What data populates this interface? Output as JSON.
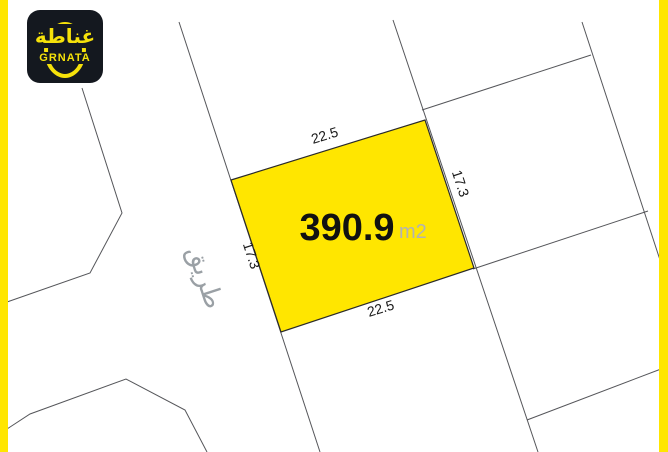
{
  "logo": {
    "arabic": "غناطة",
    "latin": "GRNATA"
  },
  "plot": {
    "area": "390.9",
    "unit": "m2",
    "width_top": "22.5",
    "width_bottom": "22.5",
    "depth_left": "17.3",
    "depth_right": "17.3"
  },
  "road": {
    "label": "طريق"
  },
  "colors": {
    "highlight_yellow": "#FFE600",
    "frame_yellow": "#FFE600",
    "logo_bg": "#14181F",
    "logo_accent": "#F5E10A",
    "boundary_line": "#55565A",
    "area_text": "#111111",
    "unit_text": "#B3B3B3",
    "road_text": "#9AA0A5"
  }
}
